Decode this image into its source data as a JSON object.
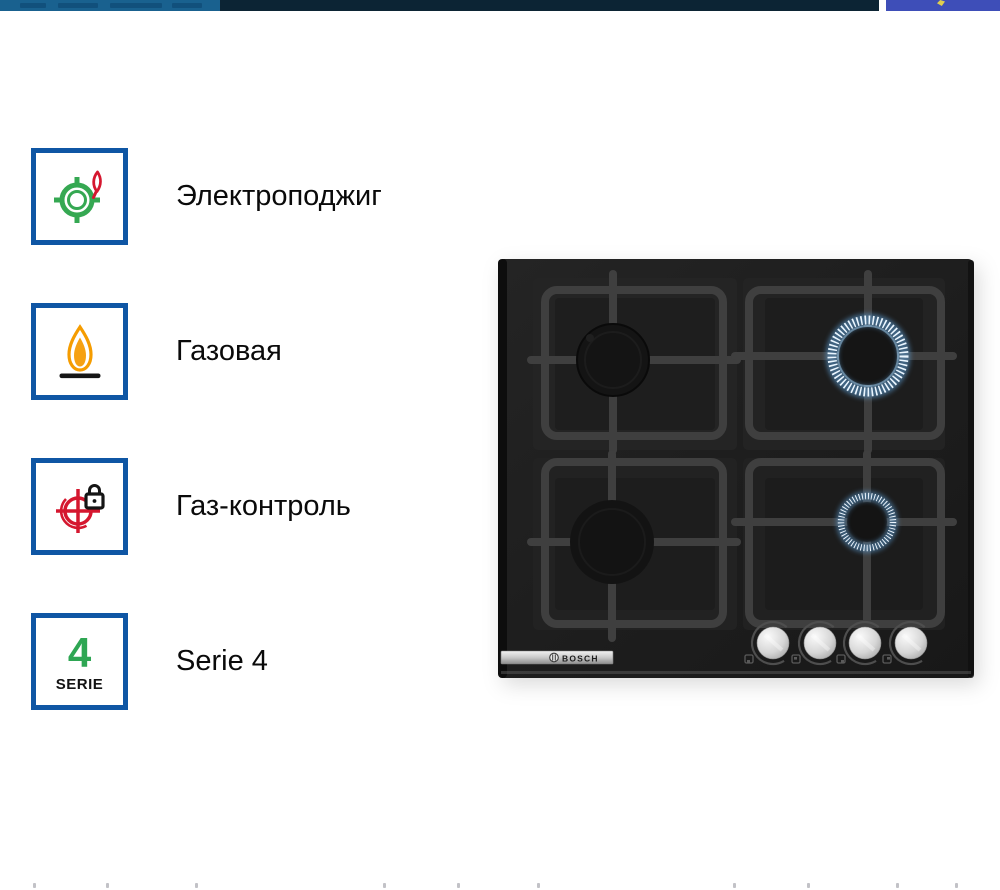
{
  "top_bar": {
    "left_color": "#19618F",
    "middle_color": "#0C2434",
    "right_color": "#3E4EB8",
    "spark_icon_color": "#DFCE4E"
  },
  "features": [
    {
      "id": "electric-ignition",
      "label": "Электроподжиг"
    },
    {
      "id": "gas",
      "label": "Газовая"
    },
    {
      "id": "gas-control",
      "label": "Газ-контроль"
    },
    {
      "id": "serie-4",
      "label": "Serie 4",
      "badge_number": "4",
      "badge_caption": "SERIE"
    }
  ],
  "product_image": {
    "brand_logo": "BOSCH",
    "description": "Black glass 4-burner gas hob, two burners lit with blue flame rings, four stainless steel control knobs",
    "knob_count": 4
  },
  "colors": {
    "feature_border": "#0F56A4",
    "green": "#35A852",
    "red": "#D5172F",
    "orange": "#F59C00",
    "label_text": "#0A0A0A",
    "flame_ring": "#EAF6FF",
    "hob_surface": "#1E1E1E",
    "grate": "#3F3F3F"
  },
  "bottom_strip": {
    "tick_color": "#C2C2C7",
    "tick_positions": [
      33,
      106,
      195,
      383,
      457,
      537,
      733,
      807,
      896,
      955
    ]
  }
}
